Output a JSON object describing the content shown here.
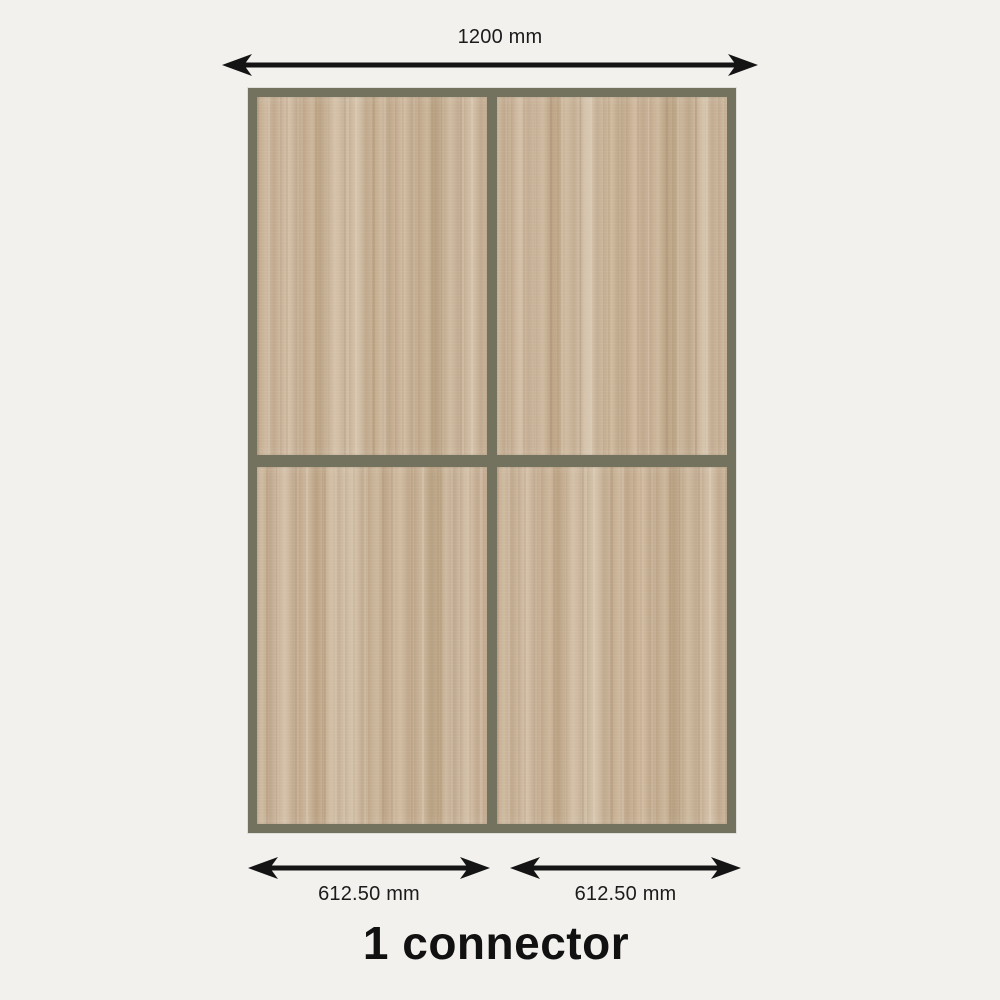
{
  "colors": {
    "background": "#f2f1ee",
    "frame": "#73725f",
    "arrow": "#141414",
    "text": "#1b1b1b",
    "wood_base": "#c8b296"
  },
  "dimensions": {
    "top": {
      "label": "1200 mm"
    },
    "bottom_left": {
      "label": "612.50 mm"
    },
    "bottom_right": {
      "label": "612.50 mm"
    }
  },
  "frame": {
    "rows": 2,
    "cols": 2,
    "panel_material": "oak-wood"
  },
  "caption": {
    "text": "1 connector"
  }
}
